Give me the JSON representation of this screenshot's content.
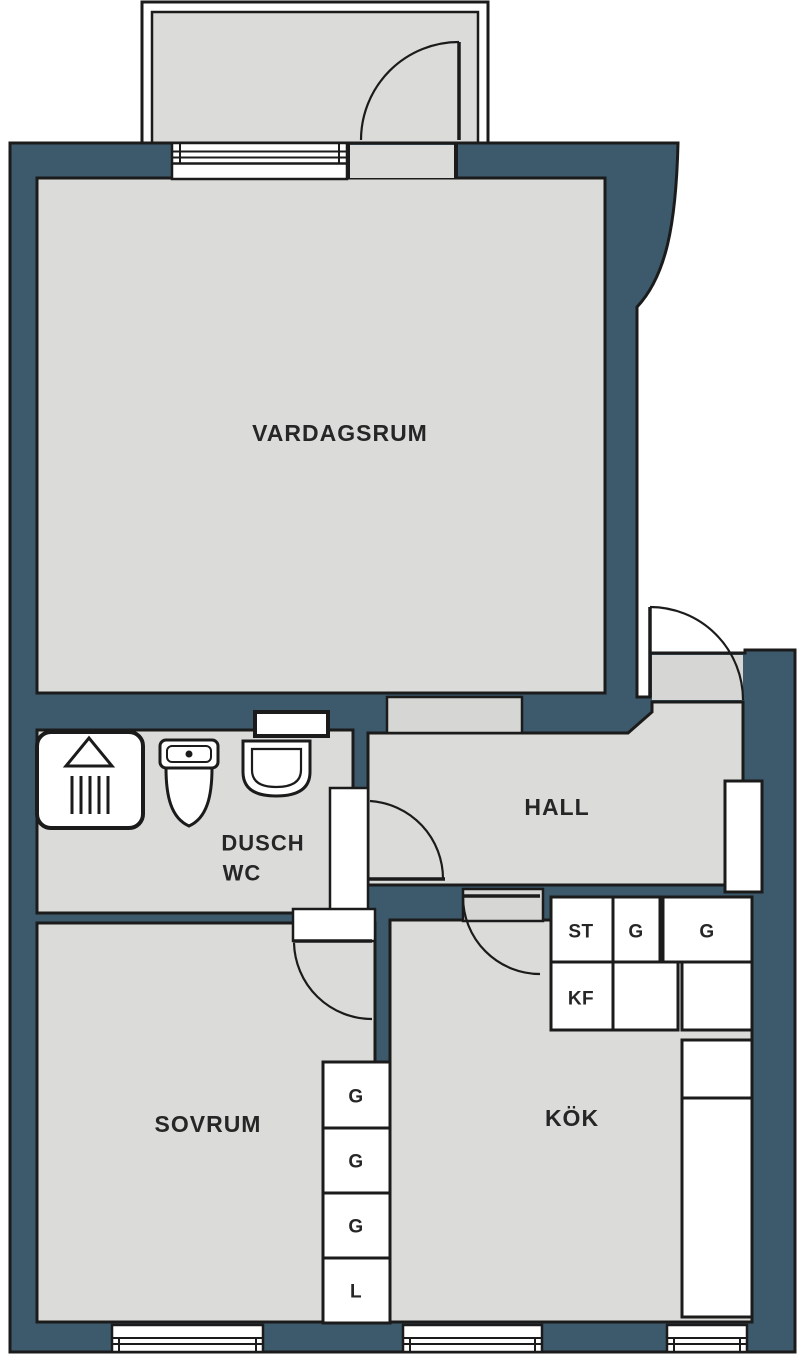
{
  "floorplan": {
    "colors": {
      "wall": "#3C5A6C",
      "room": "#DBDBD9",
      "outline": "#1B1B1B",
      "fixture": "#FFFFFF"
    },
    "rooms": {
      "vardagsrum": {
        "label": "VARDAGSRUM"
      },
      "hall": {
        "label": "HALL"
      },
      "bathroom": {
        "label_line1": "DUSCH",
        "label_line2": "WC"
      },
      "sovrum": {
        "label": "SOVRUM"
      },
      "kok": {
        "label": "KÖK"
      }
    },
    "kitchen_units": [
      {
        "label": "ST"
      },
      {
        "label": "G"
      },
      {
        "label": "G"
      },
      {
        "label": "KF"
      }
    ],
    "bedroom_closets": [
      {
        "label": "G"
      },
      {
        "label": "G"
      },
      {
        "label": "G"
      },
      {
        "label": "L"
      }
    ]
  }
}
